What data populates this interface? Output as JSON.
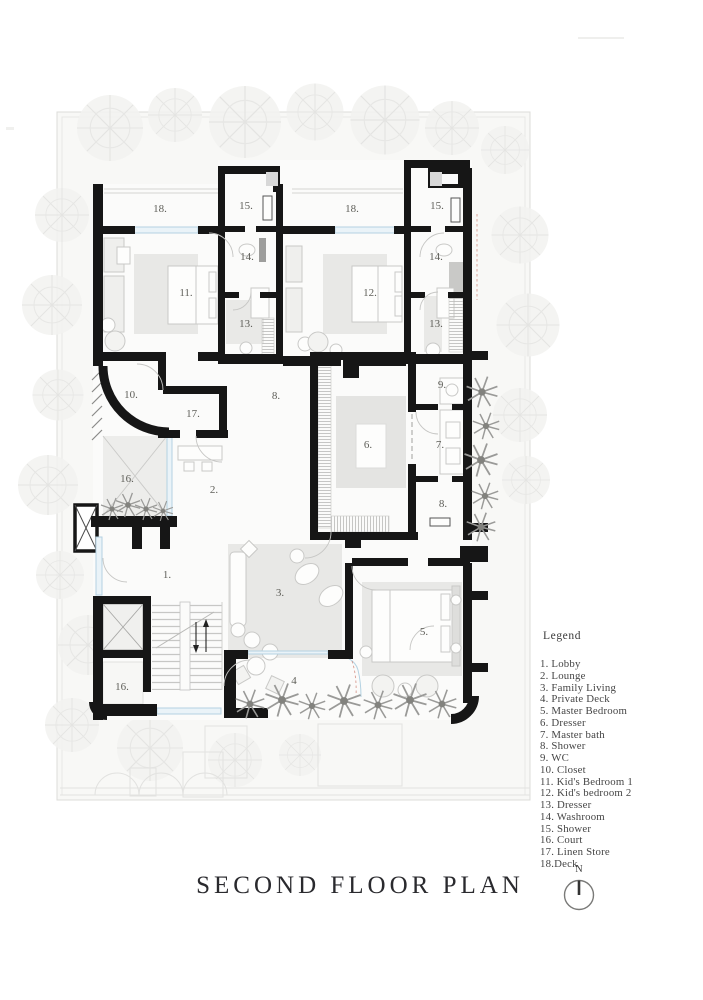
{
  "sheet": {
    "title": "SECOND FLOOR PLAN"
  },
  "north": {
    "label": "N"
  },
  "legend": {
    "title": "Legend",
    "items": [
      "1. Lobby",
      "2. Lounge",
      "3. Family Living",
      "4. Private Deck",
      "5. Master Bedroom",
      "6. Dresser",
      "7. Master bath",
      "8. Shower",
      "9. WC",
      "10. Closet",
      "11. Kid's Bedroom 1",
      "12. Kid's bedroom 2",
      "13. Dresser",
      "14. Washroom",
      "15. Shower",
      "16. Court",
      "17. Linen Store",
      "18.Deck"
    ]
  },
  "plan": {
    "room_labels": [
      {
        "text": "18."
      },
      {
        "text": "18."
      },
      {
        "text": "15."
      },
      {
        "text": "15."
      },
      {
        "text": "14."
      },
      {
        "text": "14."
      },
      {
        "text": "13."
      },
      {
        "text": "13."
      },
      {
        "text": "11."
      },
      {
        "text": "12."
      },
      {
        "text": "10."
      },
      {
        "text": "17."
      },
      {
        "text": "8."
      },
      {
        "text": "9."
      },
      {
        "text": "6."
      },
      {
        "text": "7."
      },
      {
        "text": "2."
      },
      {
        "text": "16."
      },
      {
        "text": "8."
      },
      {
        "text": "1."
      },
      {
        "text": "3."
      },
      {
        "text": "5."
      },
      {
        "text": "16."
      },
      {
        "text": "4"
      }
    ]
  },
  "colors": {
    "wall": "#161616",
    "window": "#b4d2e2",
    "window_fill": "#eaf3f8",
    "site": "#f8f8f6",
    "furniture": "#e8e8e6",
    "accent_red": "#c66a5a"
  }
}
